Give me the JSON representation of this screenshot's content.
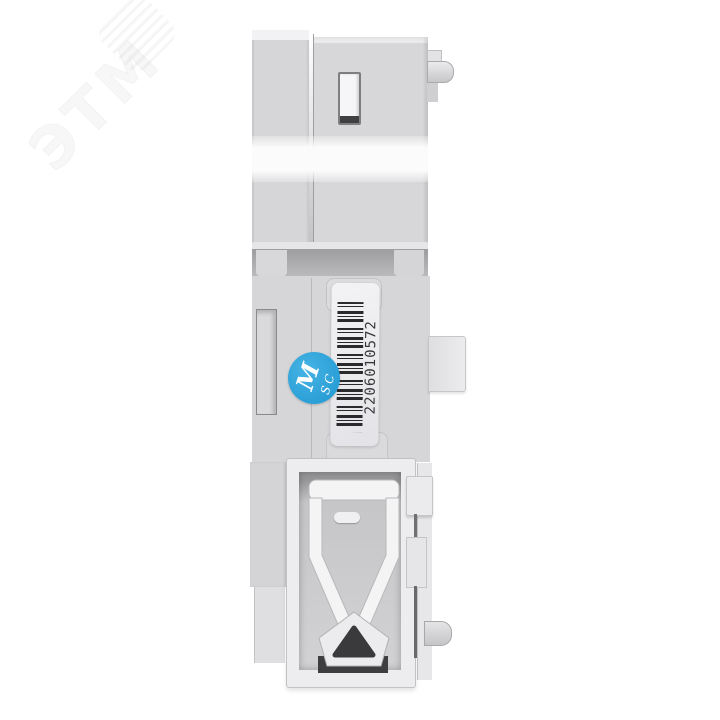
{
  "meta": {
    "type": "product-photo",
    "subject": "Side view of a light-gray modular DIN-rail electrical device with barcode label, blue QC sticker and DIN-rail mounting clip"
  },
  "watermark": {
    "text": "ЭТМ"
  },
  "label": {
    "barcode_number": "2206010572"
  },
  "qc_sticker": {
    "line1": "M",
    "line2": "SC"
  },
  "palette": {
    "background": "#ffffff",
    "body_gray": "#d6d6d8",
    "band_white": "#fbfbfc",
    "recess_gray": "#c6c6c8",
    "clip_white": "#f4f4f5",
    "sticker_blue": "#1f97d1",
    "barcode_ink": "#2a2a2c"
  }
}
